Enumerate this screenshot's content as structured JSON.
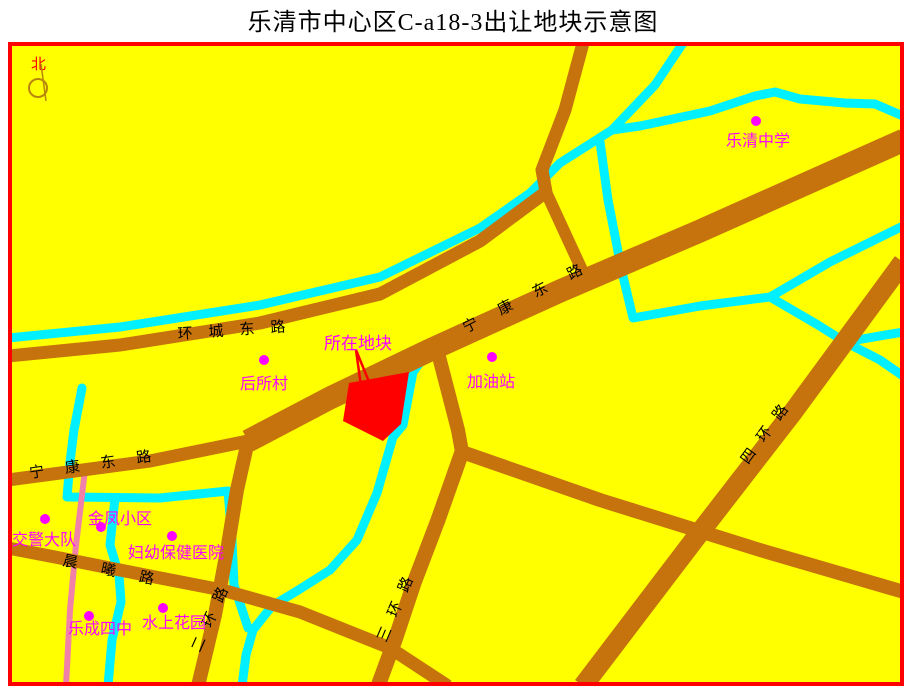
{
  "title": "乐清市中心区C-a18-3出让地块示意图",
  "compass": {
    "label": "北"
  },
  "parcel": {
    "label": "所在地块"
  },
  "roads": {
    "huancheng": "环城东路",
    "ningkang_main": "宁康东路",
    "ningkang_west": "宁康东路",
    "chenxi": "晨曦路",
    "erhuan": "二环路",
    "sanhuan": "三环路",
    "sihuan": "四环路"
  },
  "pois": {
    "yueqing_middle_school": "乐清中学",
    "housuo_village": "后所村",
    "gas_station": "加油站",
    "jinfeng_community": "金凤小区",
    "traffic_police": "交警大队",
    "mch_hospital": "妇幼保健医院",
    "yuecheng_no4_school": "乐成四中",
    "water_garden": "水上花园"
  },
  "colors": {
    "background": "#ffff00",
    "map_border": "#ff0000",
    "road": "#c6730d",
    "river": "#00f0ff",
    "pink_road": "#f082aa",
    "parcel_fill": "#ff0000",
    "poi_marker": "#ff00ff",
    "road_label": "#000000"
  }
}
